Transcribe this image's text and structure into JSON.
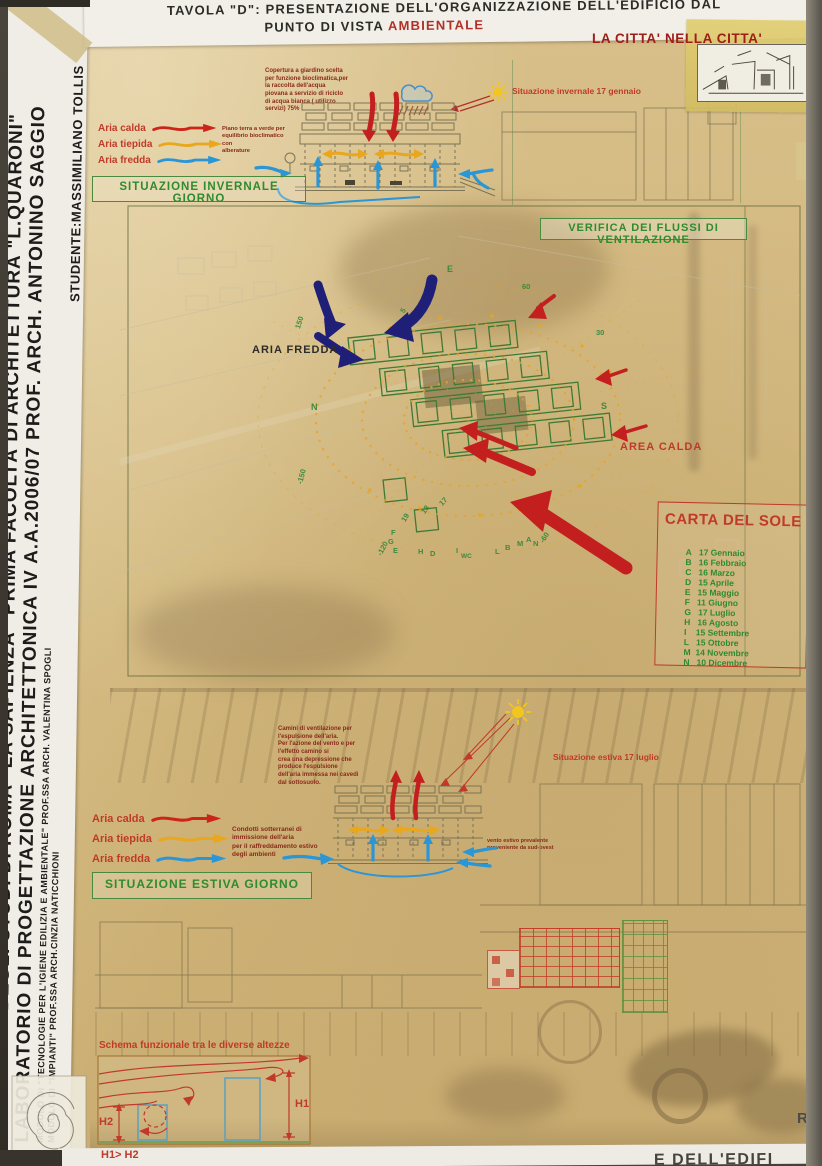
{
  "colors": {
    "aria_calda": "#cc2418",
    "aria_tiepida": "#e8a71c",
    "aria_fredda": "#2a96d6",
    "accent_red": "#b03028",
    "accent_green": "#2e8b2e",
    "navy_arrow": "#1f1f78",
    "poster_tan": "#d2b77c"
  },
  "header": {
    "title_line1": "TAVOLA \"D\": PRESENTAZIONE DELL'ORGANIZZAZIONE DELL'EDIFICIO DAL",
    "title_line2_prefix": "PUNTO DI VISTA ",
    "title_line2_accent": "AMBIENTALE",
    "motto": "LA CITTA' NELLA CITTA'"
  },
  "sidebar": {
    "line1": "UNIVERSITÀ DEGLI STUDI DI ROMA \"LA SAPIENZA\" PRIMA FACOLTÀ DI ARCHITETTURA \"L.QUARONI\"",
    "line2": "LABORATORIO DI PROGETTAZIONE ARCHITETTONICA IV A.A.2006/07 PROF. ARCH. ANTONINO SAGGIO",
    "module1": "MODULO DI \"TECNOLOGIE PER L'IGIENE EDILIZIA E AMBIENTALE\" PROF.SSA ARCH. VALENTINA SPOGLI",
    "module2": "MODULO DI \"IMPIANTI\" PROF.SSA ARCH.CINZIA NATICCHIONI",
    "student": "STUDENTE:MASSIMILIANO TOLLIS"
  },
  "legend": {
    "items": [
      {
        "label": "Aria calda"
      },
      {
        "label": "Aria tiepida"
      },
      {
        "label": "Aria fredda"
      }
    ]
  },
  "winter": {
    "roof_note": "Copertura a giardino scelta\nper funzione bioclimatica,per\nla raccolta dell'acqua\npiovana a servizio di riciclo\ndi acqua bianca ( utilizzo\nservizi) 75%",
    "ground_note": "Piano terra a verde per\nequilibrio bioclimatico con\nalberature",
    "caption": "Situazione  invernale 17 gennaio",
    "box_label": "SITUAZIONE  INVERNALE GIORNO"
  },
  "plan": {
    "box_label": "VERIFICA DEI FLUSSI DI VENTILAZIONE",
    "aria_fredda": "ARIA FREDDA",
    "area_calda": "AREA CALDA",
    "ticks": [
      "E",
      "60",
      "30",
      "S",
      "N",
      "150",
      "-150",
      "5",
      "-120",
      "F",
      "G",
      "E",
      "19",
      "18",
      "17",
      "H",
      "D",
      "I",
      "WC",
      "L",
      "B",
      "M",
      "A",
      "N",
      "-60"
    ]
  },
  "carta_del_sole": {
    "title": "CARTA DEL SOLE",
    "rows": [
      {
        "k": "A",
        "v": "17 Gennaio"
      },
      {
        "k": "B",
        "v": "16 Febbraio"
      },
      {
        "k": "C",
        "v": "16 Marzo"
      },
      {
        "k": "D",
        "v": "15 Aprile"
      },
      {
        "k": "E",
        "v": "15 Maggio"
      },
      {
        "k": "F",
        "v": "11 Giugno"
      },
      {
        "k": "G",
        "v": "17 Luglio"
      },
      {
        "k": "H",
        "v": "16 Agosto"
      },
      {
        "k": "I",
        "v": "15 Settembre"
      },
      {
        "k": "L",
        "v": "15 Ottobre"
      },
      {
        "k": "M",
        "v": "14 Novembre"
      },
      {
        "k": "N",
        "v": "10 Dicembre"
      }
    ]
  },
  "summer": {
    "chimney_note": "Camini di ventilazione per\nl'espulsione dell'aria.\nPer l'azione del vento e per\nl'effetto camino si\ncrea una depressione che\nproduce l'espulsione\ndell'aria immessa nei cavedi\ndal sottosuolo.",
    "duct_note": "Condotti sotterranei di\nimmissione dell'aria\nper il raffreddamento estivo\ndegli ambienti",
    "wind_note": "vento estivo prevalente\nproveniente da sud-ovest",
    "caption": "Situazione  estiva 17 luglio",
    "box_label": "SITUAZIONE  ESTIVA GIORNO"
  },
  "schema": {
    "title": "Schema funzionale tra le diverse altezze",
    "h1": "H1",
    "h2": "H2",
    "relation": "H1> H2"
  },
  "footer": {
    "corner_letter": "R",
    "partial_title": "E DELL'EDIFI"
  }
}
